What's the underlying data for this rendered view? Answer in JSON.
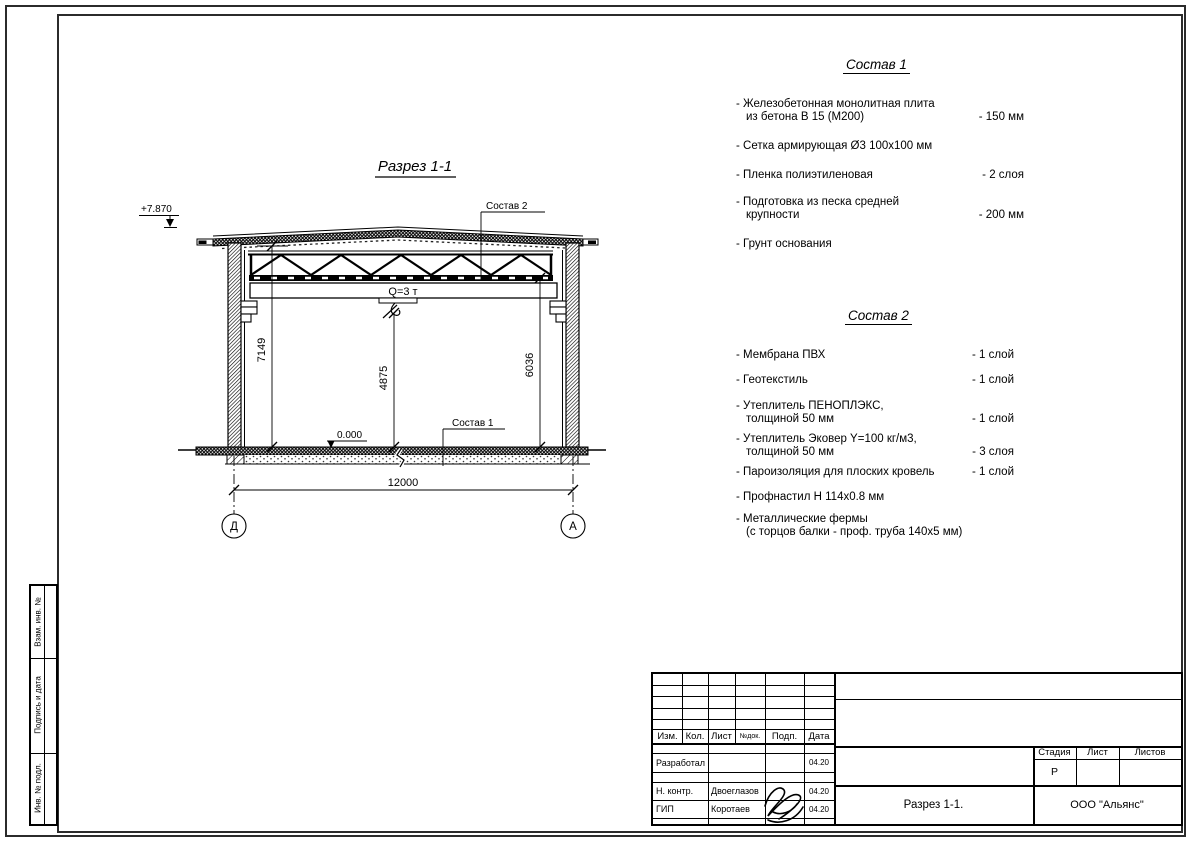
{
  "drawing": {
    "title": "Разрез 1-1",
    "elevation_top": "+7.870",
    "elevation_floor": "0.000",
    "crane_capacity": "Q=3 т",
    "callout_roof": "Состав 2",
    "callout_floor": "Состав 1",
    "dim_left": "7149",
    "dim_center": "4875",
    "dim_right": "6036",
    "dim_span": "12000",
    "axis_left": "Д",
    "axis_right": "А"
  },
  "sostav1": {
    "title": "Состав 1",
    "items": [
      {
        "line1": "- Железобетонная  монолитная плита",
        "line2": "из бетона В 15 (М200)",
        "value": "- 150 мм"
      },
      {
        "line1": "- Сетка армирующая Ø3 100х100 мм",
        "line2": "",
        "value": ""
      },
      {
        "line1": "- Пленка полиэтиленовая",
        "line2": "",
        "value": "- 2 слоя"
      },
      {
        "line1": "- Подготовка из песка средней",
        "line2": "крупности",
        "value": "- 200 мм"
      },
      {
        "line1": "- Грунт основания",
        "line2": "",
        "value": ""
      }
    ]
  },
  "sostav2": {
    "title": "Состав 2",
    "items": [
      {
        "line1": "- Мембрана ПВХ",
        "line2": "",
        "value": "- 1 слой"
      },
      {
        "line1": "- Геотекстиль",
        "line2": "",
        "value": "- 1 слой"
      },
      {
        "line1": "- Утеплитель ПЕНОПЛЭКС,",
        "line2": "толщиной 50 мм",
        "value": "- 1 слой"
      },
      {
        "line1": "- Утеплитель Эковер Y=100 кг/м3,",
        "line2": "толщиной 50 мм",
        "value": "- 3 слоя"
      },
      {
        "line1": "- Пароизоляция для плоских кровель",
        "line2": "",
        "value": "- 1 слой"
      },
      {
        "line1": "- Профнастил Н 114х0.8 мм",
        "line2": "",
        "value": ""
      },
      {
        "line1": "- Металлические фермы",
        "line2": "(с торцов балки - проф. труба 140х5 мм)",
        "value": ""
      }
    ]
  },
  "titleblock": {
    "header": {
      "izm": "Изм.",
      "kol": "Кол.",
      "list": "Лист",
      "ndok": "№док.",
      "podp": "Подп.",
      "data": "Дата"
    },
    "rows": [
      {
        "role": "Разработал",
        "name": "",
        "date": "04.20"
      },
      {
        "role": "Н. контр.",
        "name": "Двоеглазов",
        "date": "04.20"
      },
      {
        "role": "ГИП",
        "name": "Коротаев",
        "date": "04.20"
      }
    ],
    "stage_label": "Стадия",
    "sheet_label": "Лист",
    "sheets_label": "Листов",
    "stage_value": "Р",
    "doc_title": "Разрез 1-1.",
    "company": "ООО \"Альянс\""
  },
  "sidebar": {
    "labels": [
      "Взам. инв. №",
      "Подпись и дата",
      "Инв. № подл."
    ]
  }
}
